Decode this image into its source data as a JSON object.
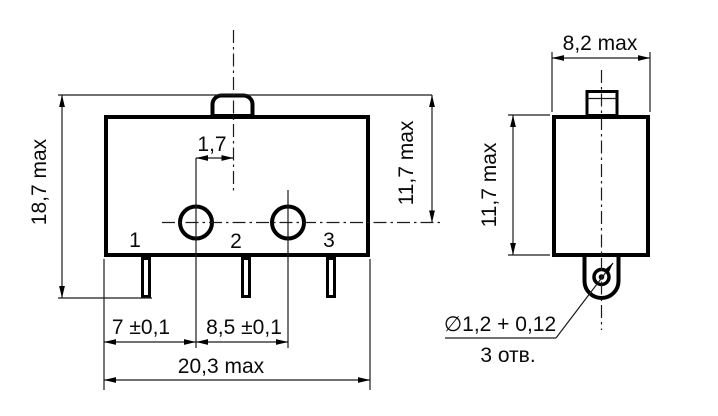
{
  "drawing": {
    "kind": "dimensional technical drawing",
    "component": "microswitch",
    "colors": {
      "line": "#000000",
      "background": "#ffffff",
      "text": "#0a0a0a"
    },
    "front_view": {
      "labels": {
        "overall_height": "18,7 max",
        "plunger_to_hole_offset": "1,7",
        "top_to_hole_axis": "11,7 max",
        "edge_to_first_hole": "7 ±0,1",
        "hole_spacing": "8,5 ±0,1",
        "overall_width": "20,3 max"
      },
      "pin_numbers": [
        "1",
        "2",
        "3"
      ]
    },
    "side_view": {
      "labels": {
        "overall_depth": "8,2 max",
        "body_height": "11,7 max",
        "hole_diameter": "∅1,2 + 0,12",
        "hole_count": "3 отв."
      }
    }
  }
}
